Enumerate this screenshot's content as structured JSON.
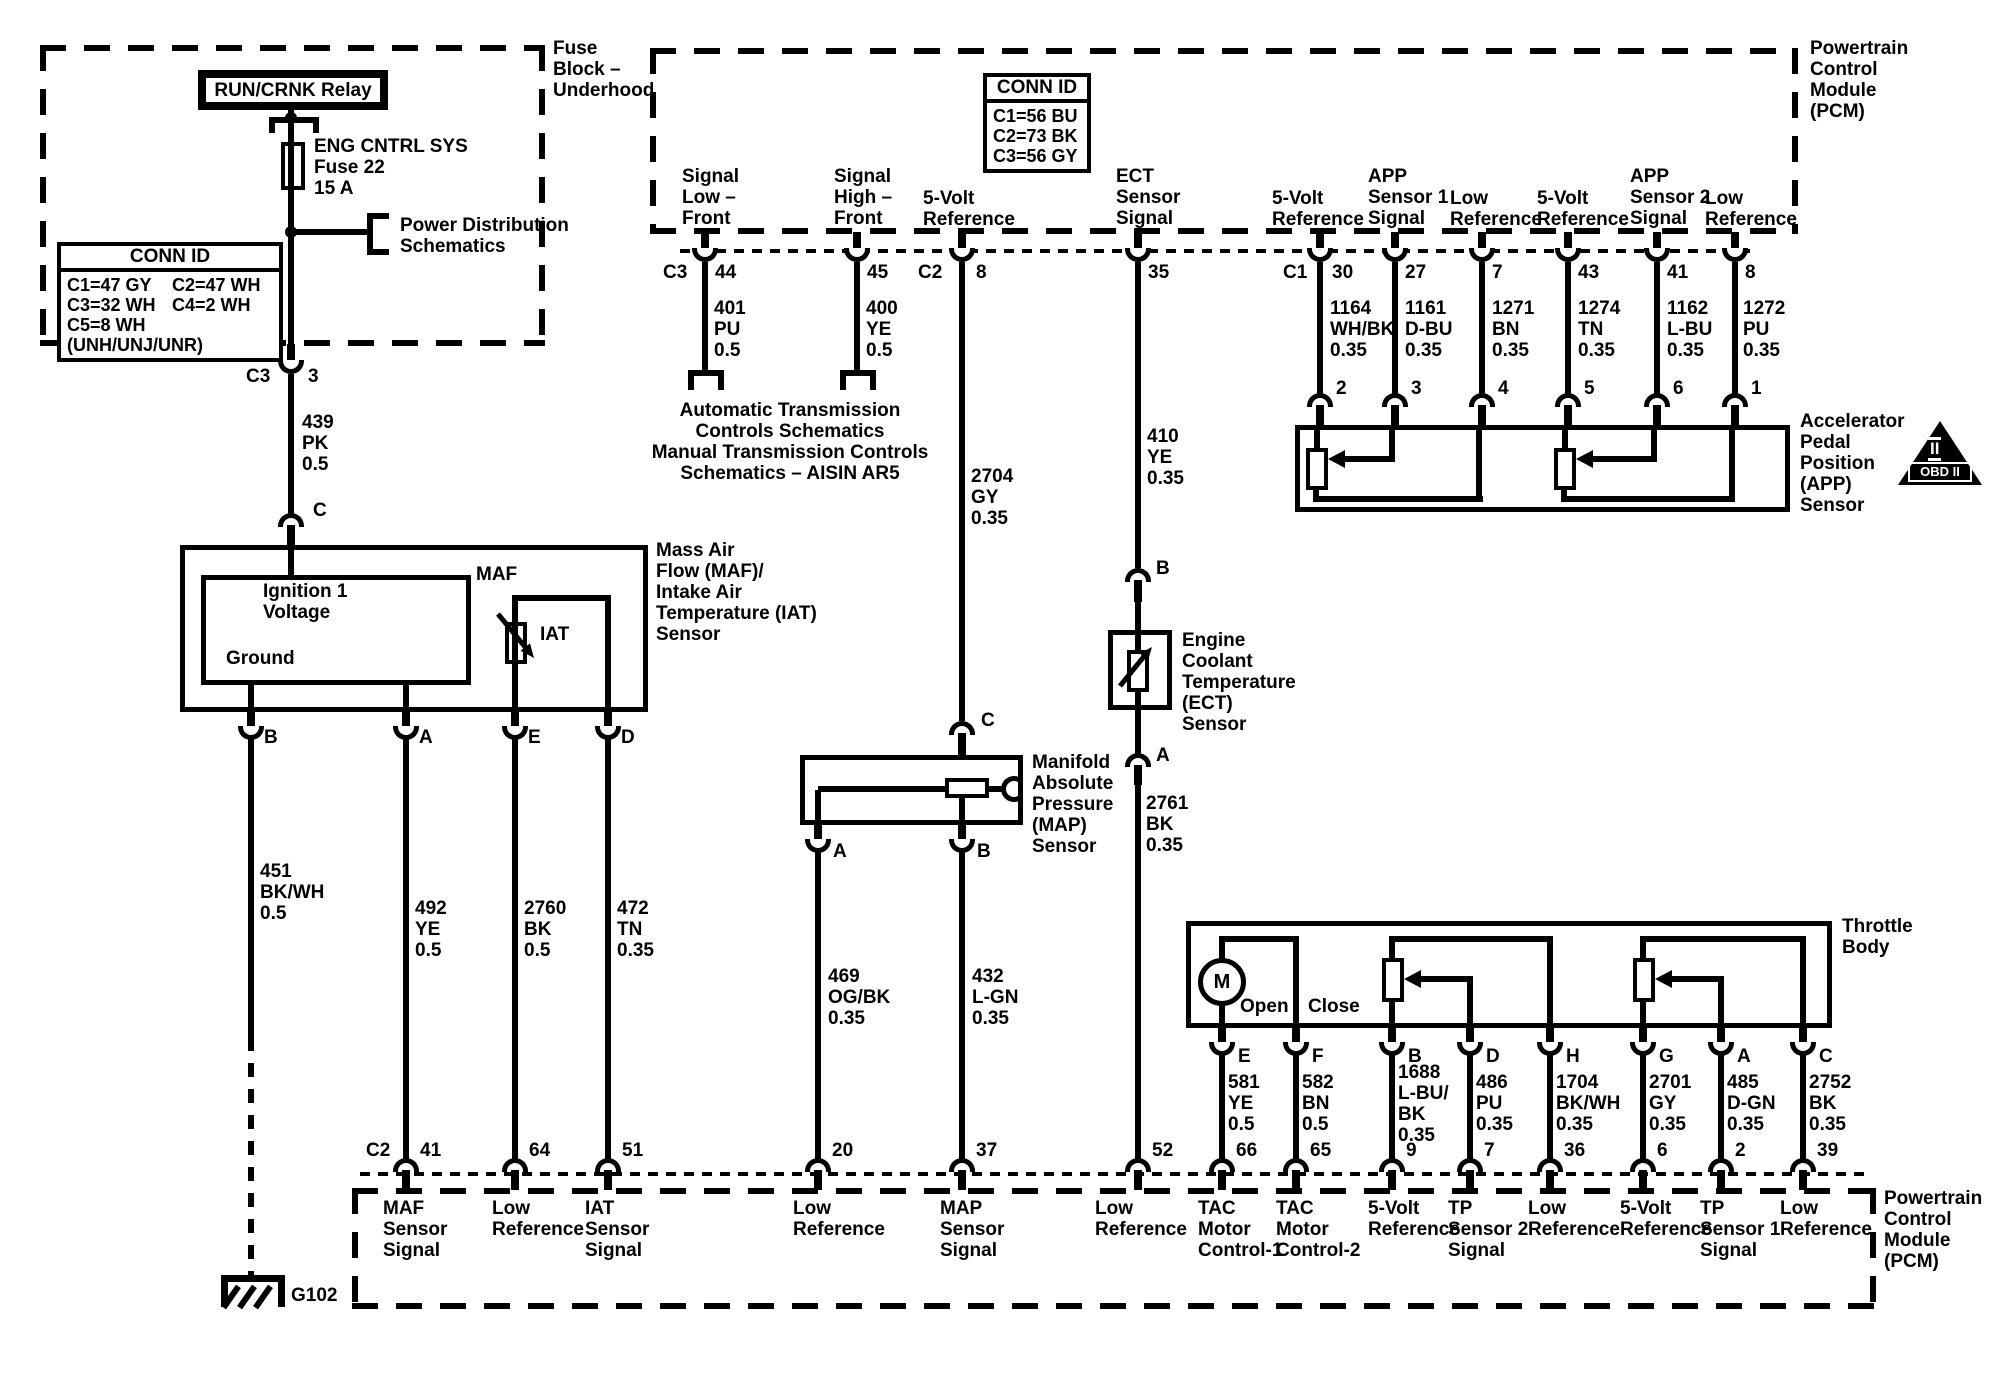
{
  "colors": {
    "line": "#000000",
    "background": "#ffffff"
  },
  "fuse_block": {
    "title": "Fuse\nBlock –\nUnderhood",
    "relay": "RUN/CRNK Relay",
    "fuse": "ENG CNTRL SYS\nFuse 22\n15 A",
    "power_dist": "Power Distribution\nSchematics",
    "conn_id": {
      "header": "CONN ID",
      "cells": [
        "C1=47 GY",
        "C2=47 WH",
        "C3=32 WH",
        "C4=2 WH",
        "C5=8 WH (UNH/UNJ/UNR)"
      ]
    },
    "out_conn": "C3",
    "out_pin": "3"
  },
  "feed": {
    "wire_439": "439\nPK\n0.5",
    "conn_c": "C"
  },
  "pcm_top": {
    "title": "Powertrain\nControl\nModule\n(PCM)",
    "conn_id": {
      "header": "CONN ID",
      "rows": [
        "C1=56 BU",
        "C2=73 BK",
        "C3=56 GY"
      ]
    },
    "signals": [
      "Signal\nLow –\nFront",
      "Signal\nHigh –\nFront",
      "5-Volt\nReference",
      "ECT\nSensor\nSignal",
      "5-Volt\nReference",
      "APP\nSensor 1\nSignal",
      "Low\nReference",
      "5-Volt\nReference",
      "APP\nSensor 2\nSignal",
      "Low\nReference"
    ],
    "pins": {
      "c3": "C3",
      "p44": "44",
      "p45": "45",
      "c2": "C2",
      "p8": "8",
      "p35": "35",
      "c1": "C1",
      "p30": "30",
      "p27": "27",
      "p7": "7",
      "p43": "43",
      "p41": "41",
      "p8b": "8"
    }
  },
  "trans": {
    "w401": "401\nPU\n0.5",
    "w400": "400\nYE\n0.5",
    "note": "Automatic Transmission\nControls Schematics\nManual Transmission Controls\nSchematics – AISIN AR5"
  },
  "map": {
    "w2704": "2704\nGY\n0.35",
    "conn_c": "C",
    "label": "Manifold\nAbsolute\nPressure\n(MAP)\nSensor",
    "pin_a": "A",
    "pin_b": "B",
    "w469": "469\nOG/BK\n0.35",
    "w432": "432\nL-GN\n0.35"
  },
  "ect": {
    "w410": "410\nYE\n0.35",
    "pin_b": "B",
    "label": "Engine\nCoolant\nTemperature\n(ECT)\nSensor",
    "pin_a": "A",
    "w2761": "2761\nBK\n0.35"
  },
  "app": {
    "wires": [
      "1164\nWH/BK\n0.35",
      "1161\nD-BU\n0.35",
      "1271\nBN\n0.35",
      "1274\nTN\n0.35",
      "1162\nL-BU\n0.35",
      "1272\nPU\n0.35"
    ],
    "pins": [
      "2",
      "3",
      "4",
      "5",
      "6",
      "1"
    ],
    "label": "Accelerator\nPedal\nPosition\n(APP)\nSensor"
  },
  "obd": {
    "numeral": "II",
    "label": "OBD II"
  },
  "maf": {
    "label": "Mass Air\nFlow (MAF)/\nIntake Air\nTemperature (IAT)\nSensor",
    "box": "MAF",
    "iat": "IAT",
    "ignition": "Ignition 1\nVoltage",
    "ground": "Ground",
    "pins": [
      "B",
      "A",
      "E",
      "D"
    ],
    "wires": [
      "451\nBK/WH\n0.5",
      "492\nYE\n0.5",
      "2760\nBK\n0.5",
      "472\nTN\n0.35"
    ]
  },
  "throttle": {
    "label": "Throttle\nBody",
    "motor": "M",
    "open": "Open",
    "close": "Close",
    "pins": [
      "E",
      "F",
      "B",
      "D",
      "H",
      "G",
      "A",
      "C"
    ],
    "wires": [
      "581\nYE\n0.5",
      "582\nBN\n0.5",
      "1688\nL-BU/\nBK\n0.35",
      "486\nPU\n0.35",
      "1704\nBK/WH\n0.35",
      "2701\nGY\n0.35",
      "485\nD-GN\n0.35",
      "2752\nBK\n0.35"
    ]
  },
  "pcm_bottom": {
    "title": "Powertrain\nControl\nModule\n(PCM)",
    "conn_c2": "C2",
    "pins": [
      "41",
      "64",
      "51",
      "20",
      "37",
      "52",
      "66",
      "65",
      "9",
      "7",
      "36",
      "6",
      "2",
      "39"
    ],
    "labels": [
      "MAF\nSensor\nSignal",
      "Low\nReference",
      "IAT\nSensor\nSignal",
      "Low\nReference",
      "MAP\nSensor\nSignal",
      "Low\nReference",
      "TAC\nMotor\nControl-1",
      "TAC\nMotor\nControl-2",
      "5-Volt\nReference",
      "TP\nSensor 2\nSignal",
      "Low\nReference",
      "5-Volt\nReference",
      "TP\nSensor 1\nSignal",
      "Low\nReference"
    ]
  },
  "ground": {
    "label": "G102"
  }
}
